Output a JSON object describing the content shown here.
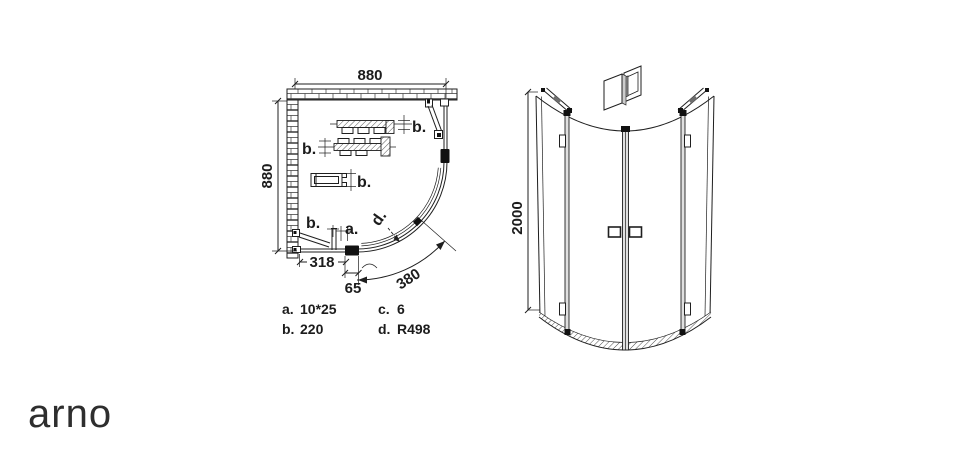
{
  "page": {
    "background": "#ffffff",
    "line_color": "#1f1f1f"
  },
  "logo": {
    "text": "arno"
  },
  "plan_view": {
    "dim_width_top": "880",
    "dim_height_left": "880",
    "dim_fixed_panel": "318",
    "dim_hinge_offset": "65",
    "dim_arc_length": "380",
    "callout_a": "a.",
    "callout_b": "b.",
    "callout_d": "d.",
    "legend": {
      "a_key": "a.",
      "a_value": "10*25",
      "b_key": "b.",
      "b_value": "220",
      "c_key": "c.",
      "c_value": "6",
      "d_key": "d.",
      "d_value": "R498"
    }
  },
  "elevation_view": {
    "dim_height": "2000"
  }
}
